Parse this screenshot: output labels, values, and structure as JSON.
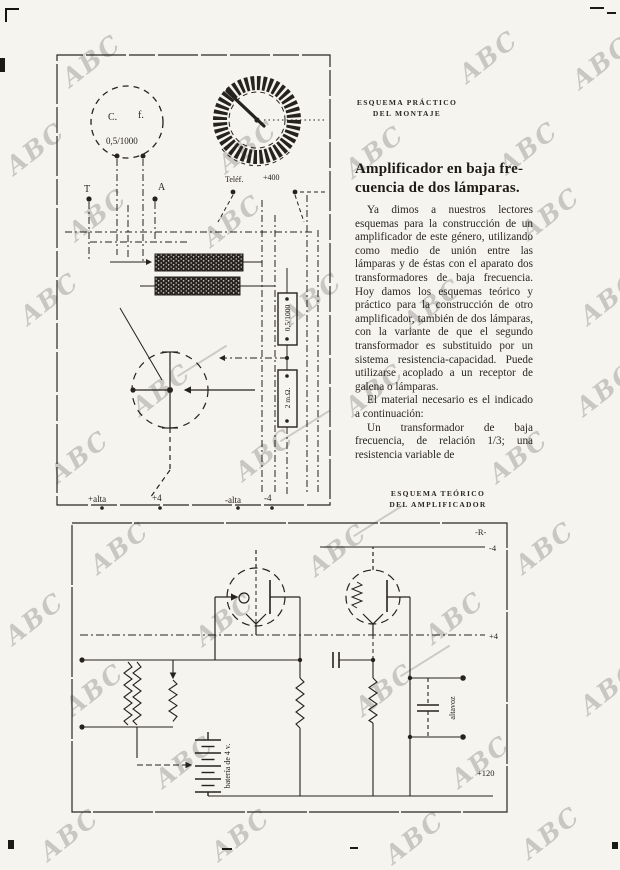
{
  "page": {
    "background": "#f6f4ee",
    "ink": "#26221e",
    "watermark_color": "#6e6e6e"
  },
  "watermarks": {
    "text": "ABC",
    "positions": [
      [
        90,
        62,
        0
      ],
      [
        487,
        58,
        0
      ],
      [
        600,
        64,
        0
      ],
      [
        34,
        150,
        0
      ],
      [
        246,
        148,
        0
      ],
      [
        373,
        153,
        0
      ],
      [
        527,
        149,
        0
      ],
      [
        96,
        216,
        0
      ],
      [
        231,
        222,
        0
      ],
      [
        549,
        215,
        0
      ],
      [
        48,
        300,
        0
      ],
      [
        311,
        300,
        0
      ],
      [
        431,
        306,
        0
      ],
      [
        608,
        300,
        0
      ],
      [
        160,
        391,
        1
      ],
      [
        373,
        391,
        0
      ],
      [
        604,
        391,
        0
      ],
      [
        78,
        458,
        0
      ],
      [
        263,
        456,
        1
      ],
      [
        517,
        458,
        0
      ],
      [
        118,
        549,
        0
      ],
      [
        336,
        551,
        1
      ],
      [
        543,
        549,
        0
      ],
      [
        33,
        620,
        0
      ],
      [
        223,
        621,
        0
      ],
      [
        453,
        619,
        0
      ],
      [
        93,
        691,
        0
      ],
      [
        383,
        691,
        1
      ],
      [
        608,
        690,
        0
      ],
      [
        183,
        763,
        0
      ],
      [
        479,
        763,
        0
      ],
      [
        68,
        836,
        0
      ],
      [
        239,
        836,
        0
      ],
      [
        413,
        839,
        0
      ],
      [
        549,
        834,
        0
      ]
    ]
  },
  "practical_diagram": {
    "caption": [
      "ESQUEMA PRÁCTICO",
      "DEL MONTAJE"
    ],
    "dial_left": {
      "c": "C.",
      "f": "f.",
      "value": "0,5/1000"
    },
    "terminal_t": "T",
    "terminal_a": "A",
    "output_label_left": "Teléf.",
    "output_label_right": "+400",
    "resistor_top": "0,5/1000",
    "resistor_bottom": "2 m.Ω.",
    "terminals": [
      "+alta",
      "+4",
      "-alta",
      "-4"
    ]
  },
  "article": {
    "title_lines": [
      "Amplificador en baja fre-",
      "cuencia de dos lámparas."
    ],
    "paragraphs": [
      "Ya dimos a nuestros lectores esquemas para la construcción de un amplificador de este género, utilizando como medio de unión entre las lámparas y de éstas con el aparato dos transformadores de baja frecuencia. Hoy damos los esquemas teórico y práctico para la construcción de otro amplificador, también de dos lámparas, con la variante de que el segundo transformador es substituido por un sistema resistencia-capacidad. Puede utilizarse acoplado a un receptor de galena o lámparas.",
      "El material necesario es el indicado a continuación:",
      "Un transformador de baja frecuencia, de relación 1/3; una resistencia variable de"
    ]
  },
  "theoretical_diagram": {
    "caption": [
      "ESQUEMA TEÓRICO",
      "DEL AMPLIFICADOR"
    ],
    "labels": {
      "top": "-R-",
      "neg4": "-4",
      "pos4": "+4",
      "pos120": "+120",
      "speaker": "altavoz",
      "battery": "batería de 4 v."
    }
  }
}
